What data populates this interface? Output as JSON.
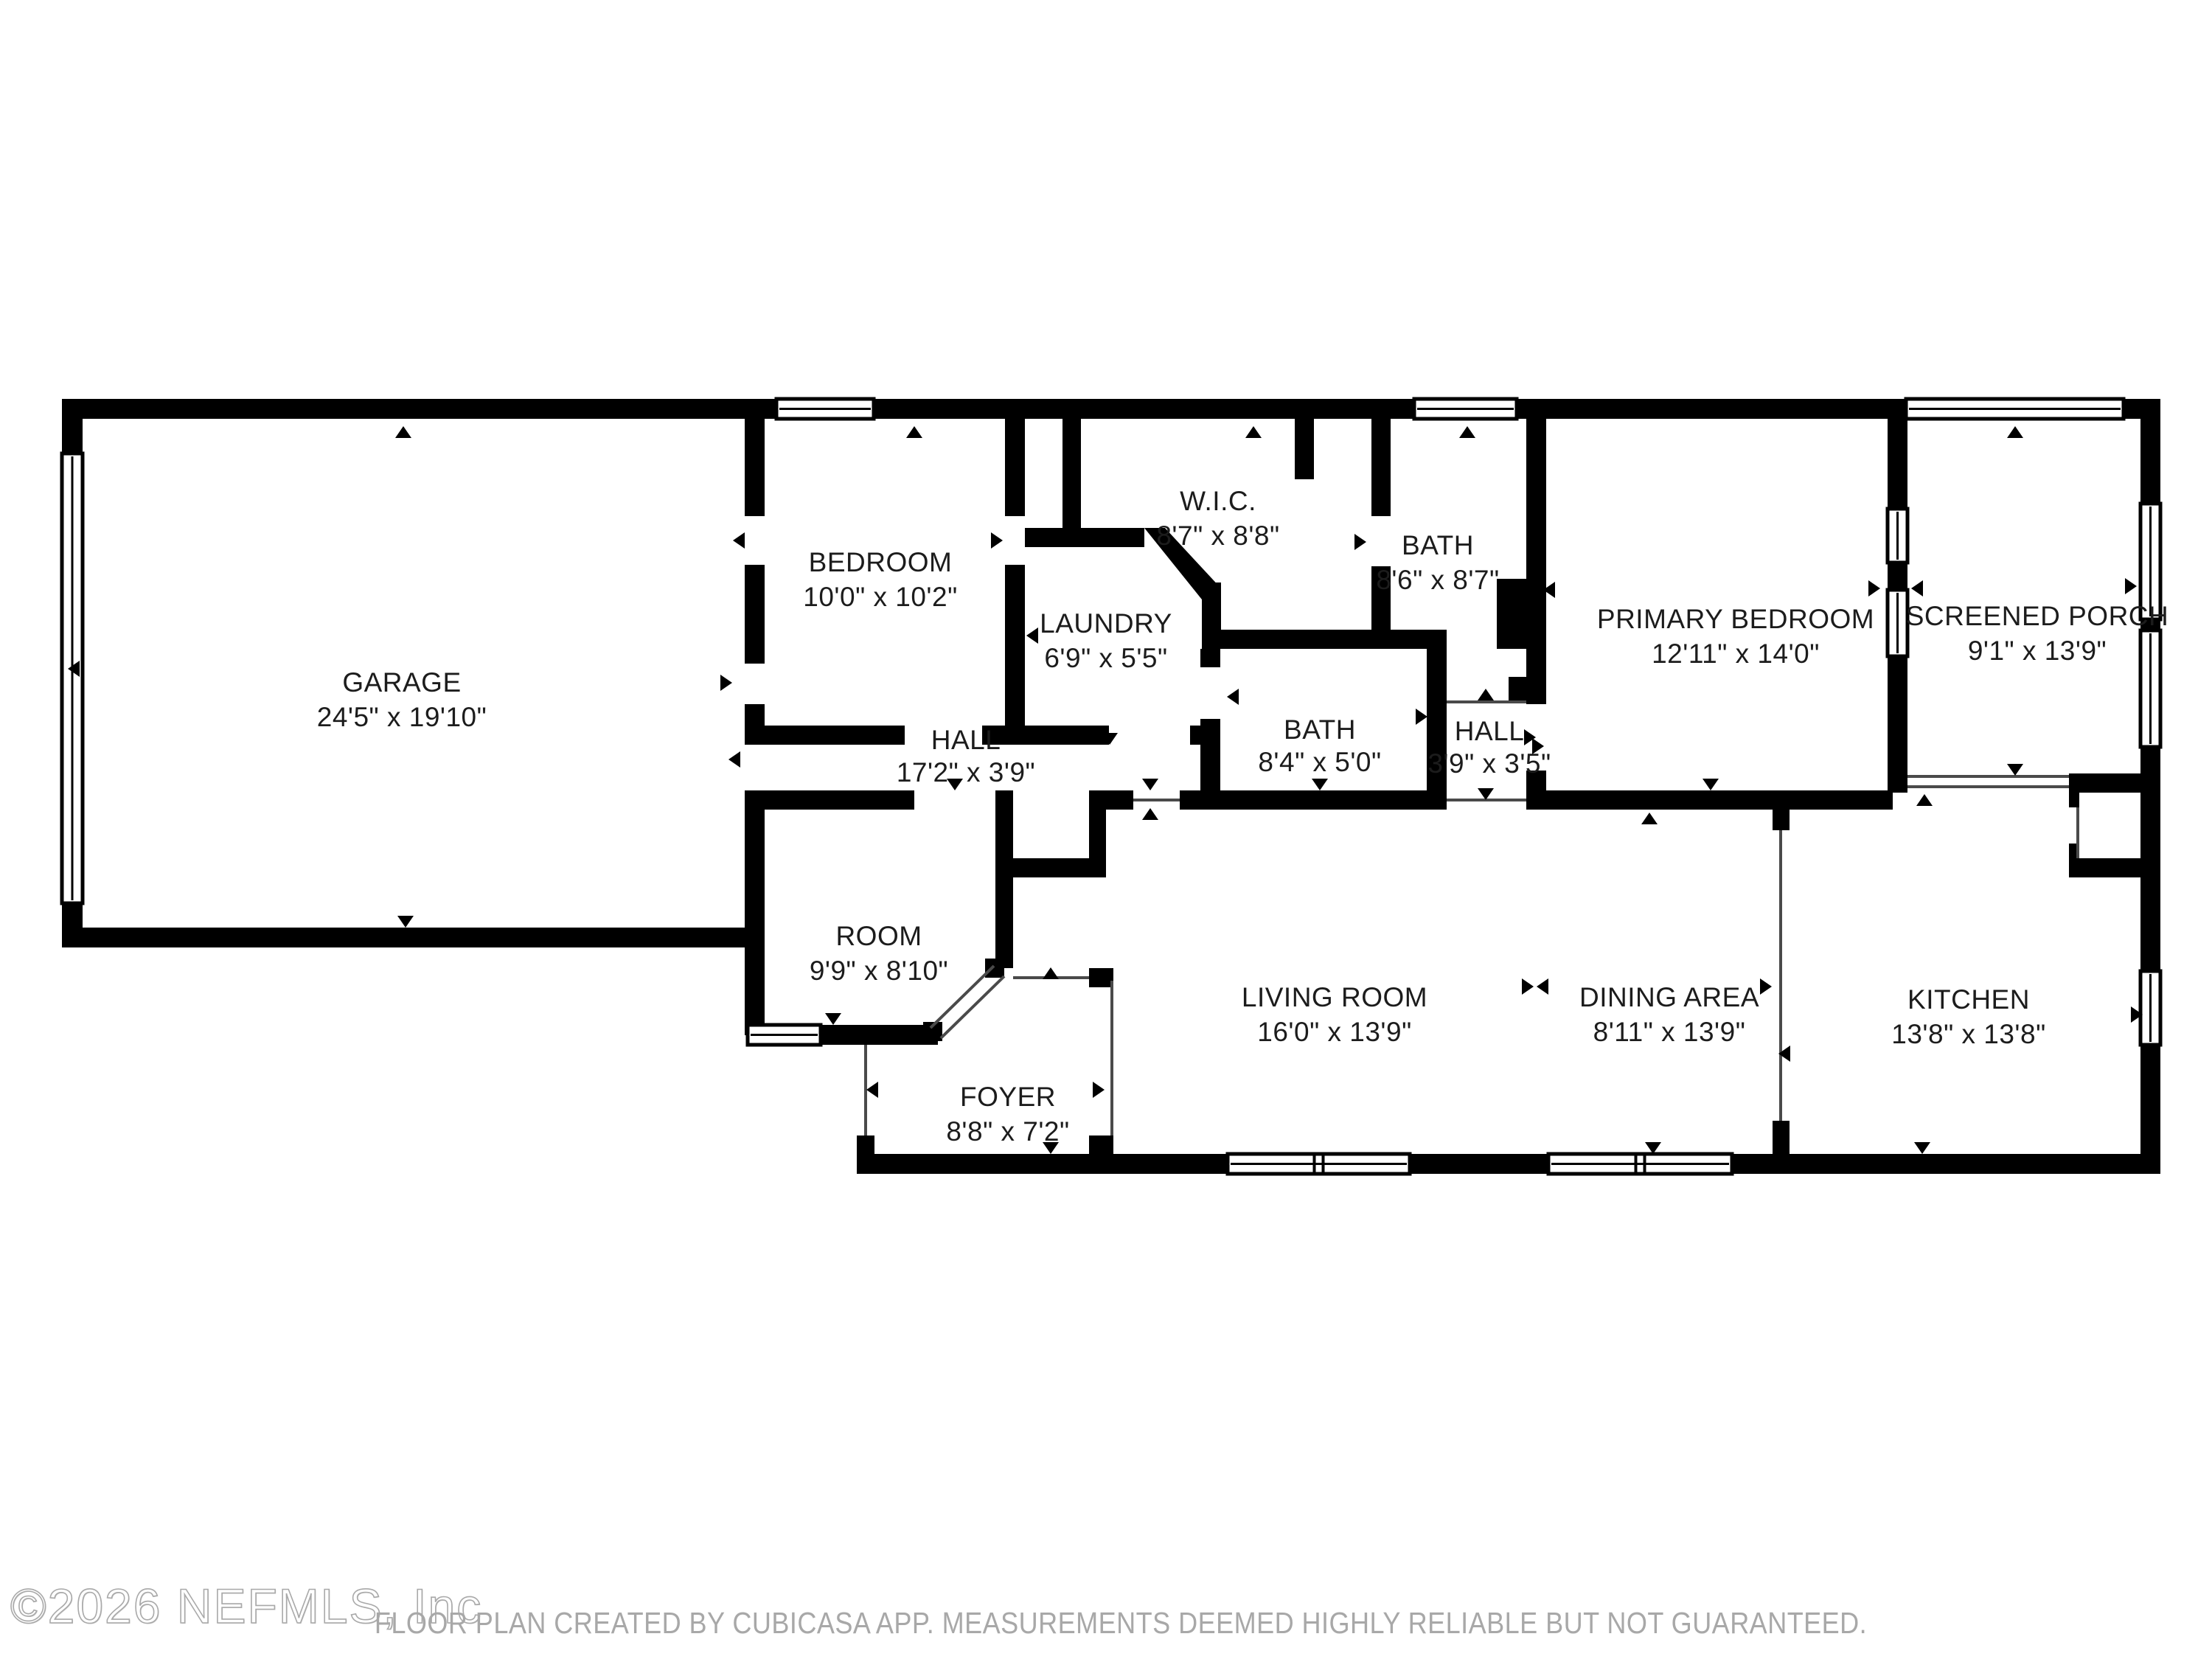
{
  "watermark": {
    "text": "©2026 NEFMLS, Inc"
  },
  "disclaimer": {
    "text": "FLOOR PLAN CREATED BY CUBICASA APP. MEASUREMENTS DEEMED HIGHLY RELIABLE BUT NOT GUARANTEED."
  },
  "rooms": [
    {
      "name": "GARAGE",
      "dims": "24'5\" x 19'10\""
    },
    {
      "name": "BEDROOM",
      "dims": "10'0\" x 10'2\""
    },
    {
      "name": "W.I.C.",
      "dims": "8'7\" x 8'8\""
    },
    {
      "name": "BATH",
      "dims": "8'6\" x 8'7\""
    },
    {
      "name": "PRIMARY BEDROOM",
      "dims": "12'11\" x 14'0\""
    },
    {
      "name": "SCREENED PORCH",
      "dims": "9'1\" x 13'9\""
    },
    {
      "name": "LAUNDRY",
      "dims": "6'9\" x 5'5\""
    },
    {
      "name": "HALL",
      "dims": "17'2\" x 3'9\""
    },
    {
      "name": "BATH",
      "dims": "8'4\" x 5'0\""
    },
    {
      "name": "HALL",
      "dims": "3'9\" x 3'5\""
    },
    {
      "name": "ROOM",
      "dims": "9'9\" x 8'10\""
    },
    {
      "name": "LIVING ROOM",
      "dims": "16'0\" x 13'9\""
    },
    {
      "name": "DINING AREA",
      "dims": "8'11\" x 13'9\""
    },
    {
      "name": "KITCHEN",
      "dims": "13'8\" x 13'8\""
    },
    {
      "name": "FOYER",
      "dims": "8'8\" x 7'2\""
    }
  ],
  "colors": {
    "wall": "#000000",
    "opening_line": "#4a4a4a",
    "label_text": "#1c1c1c",
    "disclaimer_text": "#a8a8a8",
    "watermark_text": "#bdbdbd",
    "background": "#ffffff"
  }
}
